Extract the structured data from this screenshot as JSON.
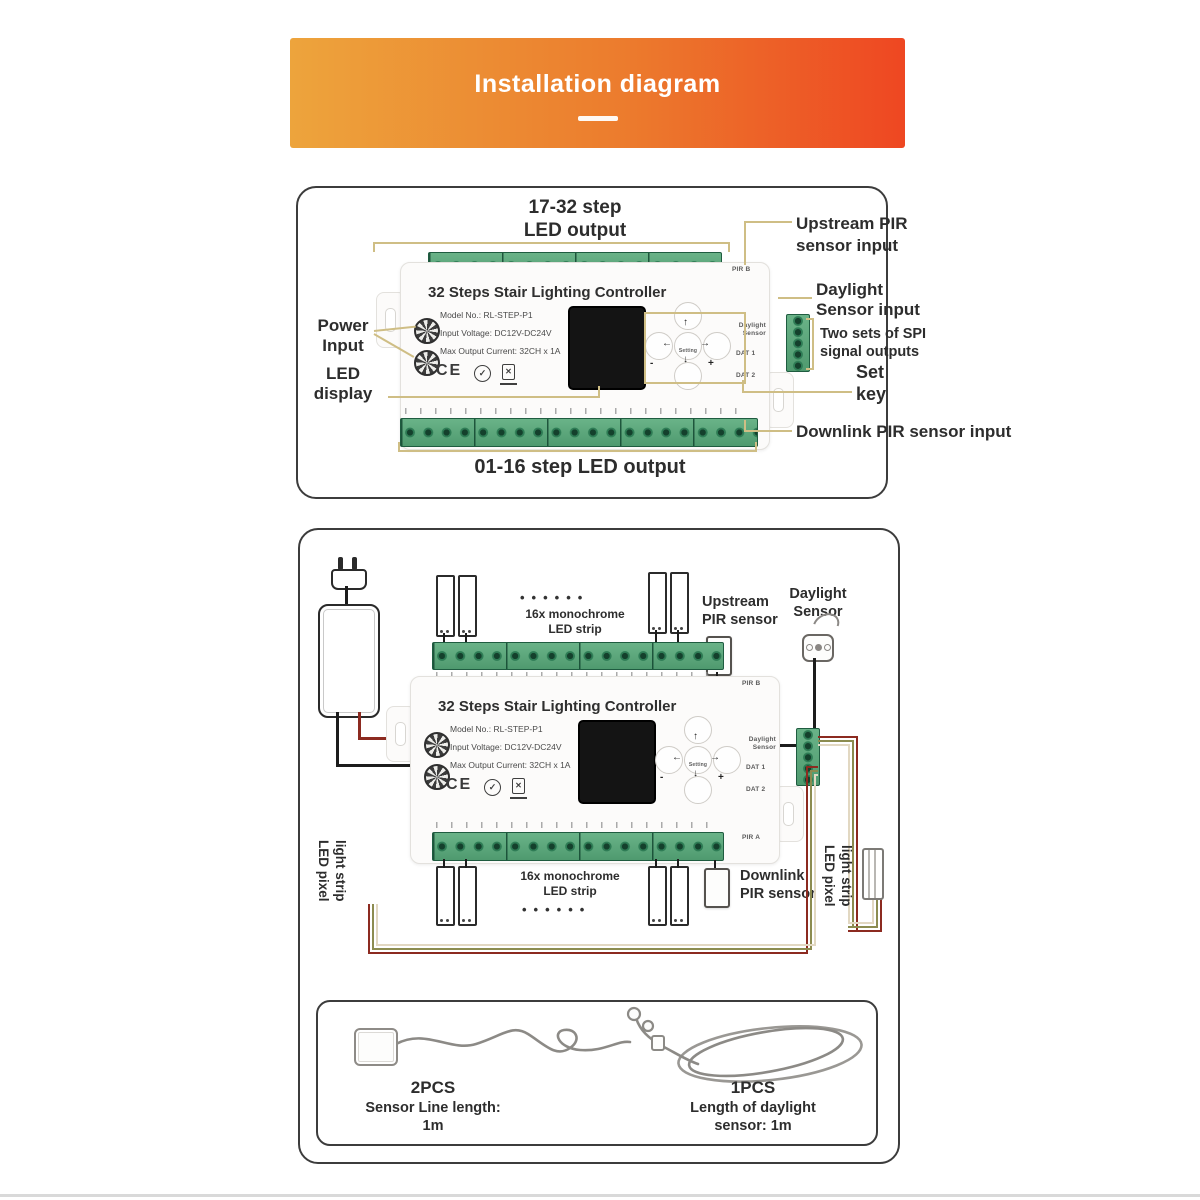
{
  "header": {
    "title": "Installation diagram"
  },
  "colors": {
    "banner_left": "#EDA43C",
    "banner_right": "#EE4722",
    "leader_line": "#CFBE85",
    "terminal_green": "#4F9A6F",
    "wire_red": "#8C2A20",
    "wire_olive": "#8C8C50",
    "wire_tan": "#E2D8C2",
    "wire_black": "#1C1C1C"
  },
  "controller": {
    "title": "32 Steps Stair Lighting Controller",
    "model": "Model No.: RL-STEP-P1",
    "voltage": "Input Voltage: DC12V-DC24V",
    "current": "Max Output Current: 32CH x 1A",
    "ce": "CE",
    "check": "✓",
    "weee": "✕",
    "pir_b": "PIR B",
    "pir_a": "PIR A",
    "daylight_port_1": "Daylight",
    "daylight_port_2": "Sensor",
    "dat1": "DAT 1",
    "dat2": "DAT 2",
    "setting": "Setting",
    "arrow_up": "↑",
    "arrow_down": "↓",
    "arrow_left": "←",
    "arrow_right": "→",
    "minus": "-",
    "plus": "+"
  },
  "top_panel": {
    "led_output_top_1": "17-32 step",
    "led_output_top_2": "LED output",
    "upstream_1": "Upstream PIR",
    "upstream_2": "sensor input",
    "daylight_1": "Daylight",
    "daylight_2": "Sensor input",
    "spi_1": "Two sets of SPI",
    "spi_2": "signal outputs",
    "set_1": "Set",
    "set_2": "key",
    "power_1": "Power",
    "power_2": "Input",
    "led_display_1": "LED",
    "led_display_2": "display",
    "downlink": "Downlink PIR sensor input",
    "led_output_bottom": "01-16 step LED output"
  },
  "middle_panel": {
    "mono_strip_top_1": "16x monochrome",
    "mono_strip_top_2": "LED strip",
    "mono_strip_bottom_1": "16x monochrome",
    "mono_strip_bottom_2": "LED strip",
    "dots": "••••••",
    "upstream_1": "Upstream",
    "upstream_2": "PIR sensor",
    "daylight_1": "Daylight",
    "daylight_2": "Sensor",
    "downlink_1": "Downlink",
    "downlink_2": "PIR sensor",
    "pixel_left_1": "LED pixel",
    "pixel_left_2": "light strip",
    "pixel_right_1": "LED pixel",
    "pixel_right_2": "light strip"
  },
  "accessories": {
    "left_qty": "2PCS",
    "left_desc_1": "Sensor Line length:",
    "left_desc_2": "1m",
    "right_qty": "1PCS",
    "right_desc_1": "Length of daylight",
    "right_desc_2": "sensor: 1m"
  }
}
